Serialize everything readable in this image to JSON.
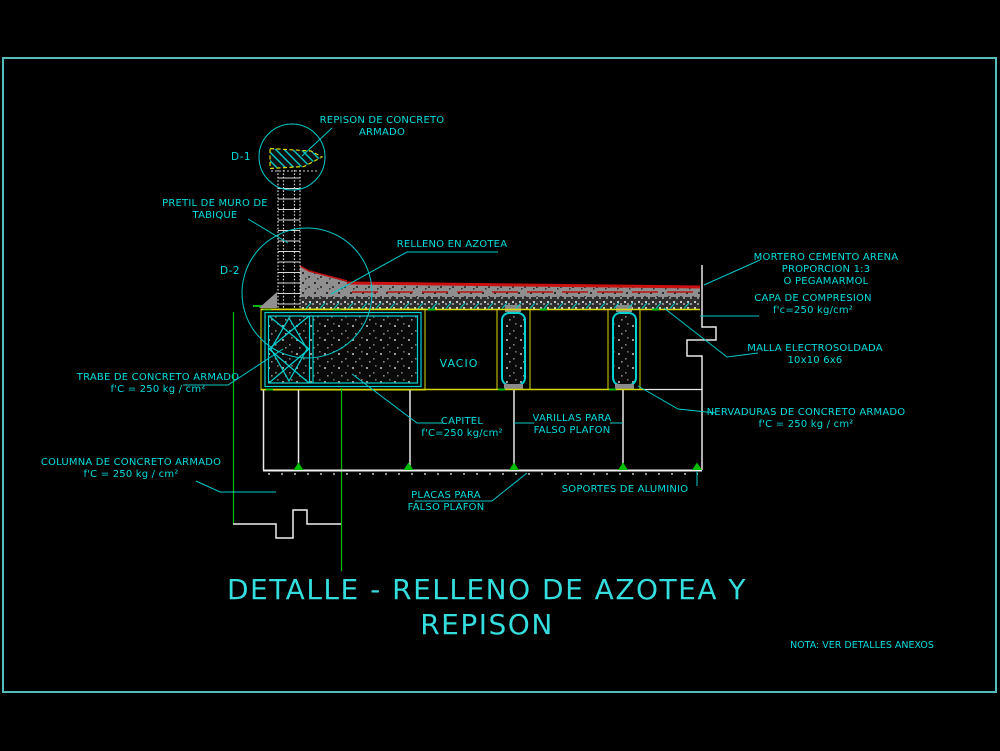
{
  "colors": {
    "background": "#000000",
    "frame": "#55bbbb",
    "annotation_cyan": "#00dcdc",
    "structure_yellow": "#d8d800",
    "mortar_red": "#cc1010",
    "support_green": "#00bc00",
    "line_white": "#f0f0f0",
    "fill_gray": "#8f8f8f"
  },
  "title": {
    "line1": "DETALLE - RELLENO DE AZOTEA Y",
    "line2": "REPISON"
  },
  "note": {
    "text": "NOTA: VER DETALLES ANEXOS"
  },
  "markers": {
    "d1": "D-1",
    "d2": "D-2"
  },
  "area": {
    "vacio": "VACIO"
  },
  "labels": {
    "repison": {
      "line1": "REPISON DE CONCRETO",
      "line2": "ARMADO"
    },
    "pretil": {
      "line1": "PRETIL DE MURO DE",
      "line2": "TABIQUE"
    },
    "relleno": {
      "line1": "RELLENO EN AZOTEA"
    },
    "mortero": {
      "line1": "MORTERO CEMENTO ARENA",
      "line2": "PROPORCION 1:3",
      "line3": "O PEGAMARMOL"
    },
    "capa": {
      "line1": "CAPA DE COMPRESION",
      "line2": "f'c=250 kg/cm²"
    },
    "malla": {
      "line1": "MALLA ELECTROSOLDADA",
      "line2": "10x10  6x6"
    },
    "nervaduras": {
      "line1": "NERVADURAS DE CONCRETO ARMADO",
      "line2": "f'C = 250 kg / cm²"
    },
    "trabe": {
      "line1": "TRABE DE CONCRETO ARMADO",
      "line2": "f'C = 250 kg / cm²"
    },
    "columna": {
      "line1": "COLUMNA DE CONCRETO ARMADO",
      "line2": "f'C = 250 kg / cm²"
    },
    "capitel": {
      "line1": "CAPITEL",
      "line2": "f'C=250 kg/cm²"
    },
    "varillas": {
      "line1": "VARILLAS PARA",
      "line2": "FALSO PLAFON"
    },
    "placas": {
      "line1": "PLACAS PARA",
      "line2": "FALSO PLAFON"
    },
    "soportes": {
      "line1": "SOPORTES DE ALUMINIO"
    }
  }
}
